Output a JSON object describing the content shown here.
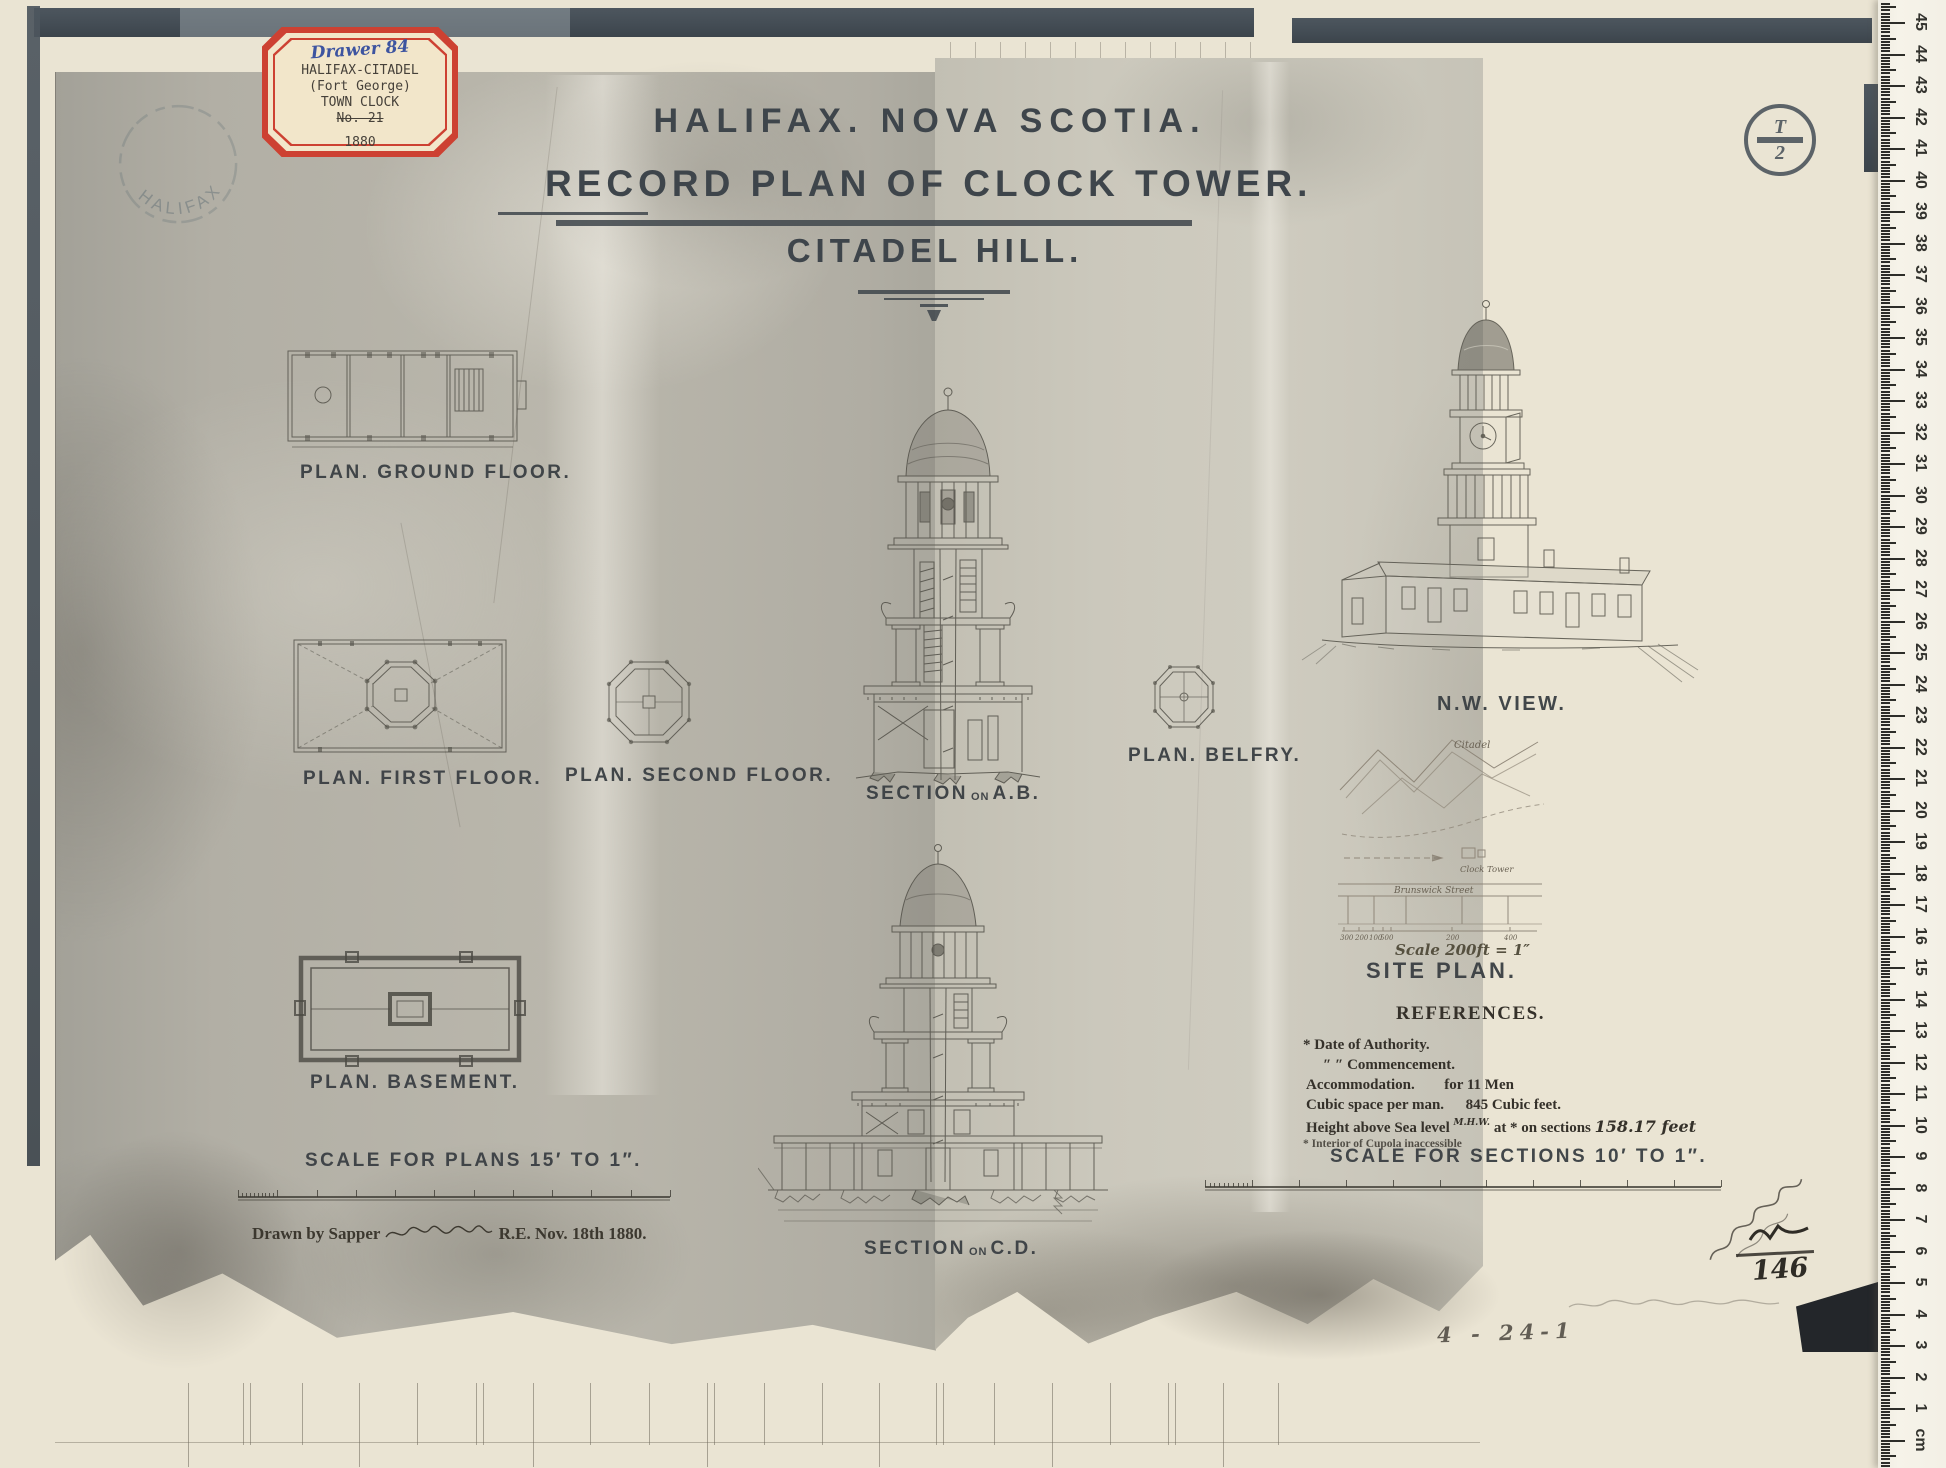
{
  "archive_label": {
    "drawer": "Drawer 84",
    "line1": "HALIFAX-CITADEL",
    "line2": "(Fort George)",
    "line3": "TOWN CLOCK",
    "line4": "No. 21",
    "year": "1880"
  },
  "stamps": {
    "halifax": "HALIFAX",
    "plate_letter": "T",
    "plate_number": "2"
  },
  "title": {
    "line1": "HALIFAX. NOVA SCOTIA.",
    "line2": "RECORD PLAN OF CLOCK TOWER.",
    "line3": "CITADEL HILL."
  },
  "labels": {
    "ground_floor": "PLAN. GROUND FLOOR.",
    "first_floor": "PLAN. FIRST FLOOR.",
    "second_floor": "PLAN. SECOND FLOOR.",
    "basement": "PLAN. BASEMENT.",
    "belfry": "PLAN. BELFRY.",
    "section_word": "SECTION",
    "section_on": "ON",
    "section_ab": "A.B.",
    "section_cd": "C.D.",
    "nw_view": "N.W. VIEW.",
    "site_plan": "SITE PLAN."
  },
  "site_plan": {
    "citadel": "Citadel",
    "clock_tower": "Clock Tower",
    "street": "Brunswick Street",
    "scale_note": "Scale 200ft = 1″",
    "ticks": [
      "300",
      "200",
      "100",
      "50",
      "0",
      "200",
      "400"
    ]
  },
  "references": {
    "title": "REFERENCES.",
    "line1": "* Date of Authority.",
    "line2": "″   ″ Commencement.",
    "line3_label": "Accommodation.",
    "line3_value": "for 11 Men",
    "line4_label": "Cubic space per man.",
    "line4_value": "845 Cubic feet.",
    "height_pre": "Height above Sea level",
    "height_insert": "M.H.W.",
    "height_post": "at * on sections",
    "height_value": "158.17 feet",
    "footnote": "* Interior of Cupola inaccessible"
  },
  "scales": {
    "plans": "SCALE FOR PLANS 15′ TO 1″.",
    "sections": "SCALE FOR SECTIONS 10′ TO 1″."
  },
  "attribution": {
    "prefix": "Drawn by Sapper",
    "suffix": "R.E. Nov. 18th 1880."
  },
  "pencil": {
    "mark1": "146",
    "mark2": "4 - 24-1"
  },
  "ruler": {
    "unit": "cm",
    "numbers": [
      45,
      44,
      43,
      42,
      41,
      40,
      39,
      38,
      37,
      36,
      35,
      34,
      33,
      32,
      31,
      30,
      29,
      28,
      27,
      26,
      25,
      24,
      23,
      22,
      21,
      20,
      19,
      18,
      17,
      16,
      15,
      14,
      13,
      12,
      11,
      10,
      9,
      8,
      7,
      6,
      5,
      4,
      3,
      2,
      1
    ]
  }
}
